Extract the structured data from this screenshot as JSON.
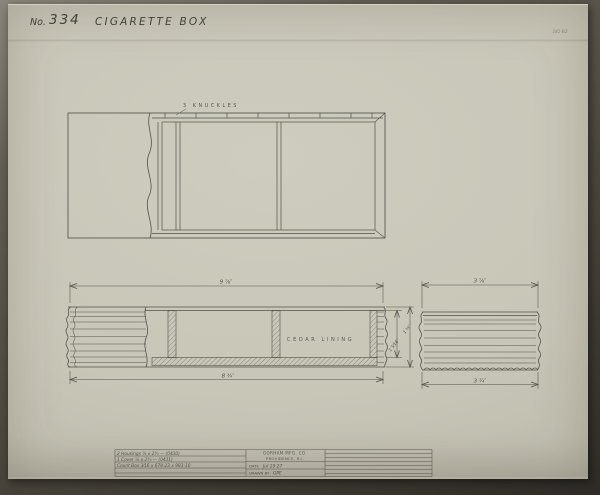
{
  "photo": {
    "mat_color": "#57534b",
    "paper_color": "#c8c6b7",
    "ink_color": "#3e3e37"
  },
  "header": {
    "no_label": "No.",
    "drawing_number": "334",
    "title": "CIGARETTE BOX",
    "corner_ref": "141-B2"
  },
  "plan_view": {
    "knuckles_label": "3 KNUCKLES"
  },
  "front_view": {
    "lining_label": "CEDAR LINING",
    "dim_length_top": "9 ⅞″",
    "dim_length_bottom": "8 ¾″",
    "dim_height_outer": "1 ⅝″",
    "dim_height_inner": "1 5⁄16″"
  },
  "end_view": {
    "dim_width_top": "3 ⅞″",
    "dim_width_bottom": "3 ¼″"
  },
  "title_block": {
    "notes": [
      "2 Housings  ⅞ x 2¾ — (0430)",
      "1 Cover  ⅞ x 2¾ — (0431)",
      "Count Box  3⁄16 x 678-23 x 983-10"
    ],
    "company": "GORHAM MFG. CO.",
    "location": "PROVIDENCE, R.I.",
    "date_label": "DATE",
    "date_value": "Jul 19 27",
    "drawn_label": "DRAWN BY",
    "drawn_value": "GPE"
  }
}
